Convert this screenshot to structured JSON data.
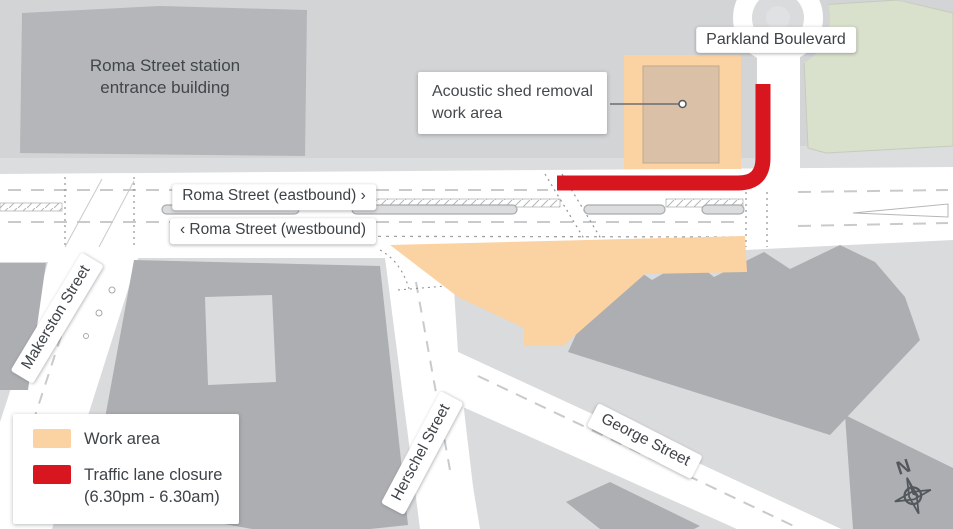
{
  "map": {
    "station_building": {
      "line1": "Roma Street station",
      "line2": "entrance building"
    },
    "callout": {
      "line1": "Acoustic shed removal",
      "line2": "work area"
    },
    "street_labels": {
      "parkland": "Parkland Boulevard",
      "roma_eastbound": "Roma Street (eastbound) ›",
      "roma_westbound": "‹ Roma Street (westbound)",
      "makerston": "Makerston Street",
      "herschel": "Herschel Street",
      "george": "George Street"
    },
    "compass_label": "N"
  },
  "legend": {
    "items": [
      {
        "label": "Work area",
        "color": "#FBD2A2"
      },
      {
        "label": "Traffic lane closure",
        "sublabel": "(6.30pm - 6.30am)",
        "color": "#D7161F"
      }
    ]
  },
  "colors": {
    "work_area": "#FBD2A2",
    "acoustic_shed": "#D9C0A7",
    "lane_closure": "#D7161F",
    "park": "#D9E1CD",
    "building": "#ACAEB1",
    "city_block": "#DADBDD",
    "station_area": "#D2D4D6",
    "road": "#FFFFFF"
  }
}
